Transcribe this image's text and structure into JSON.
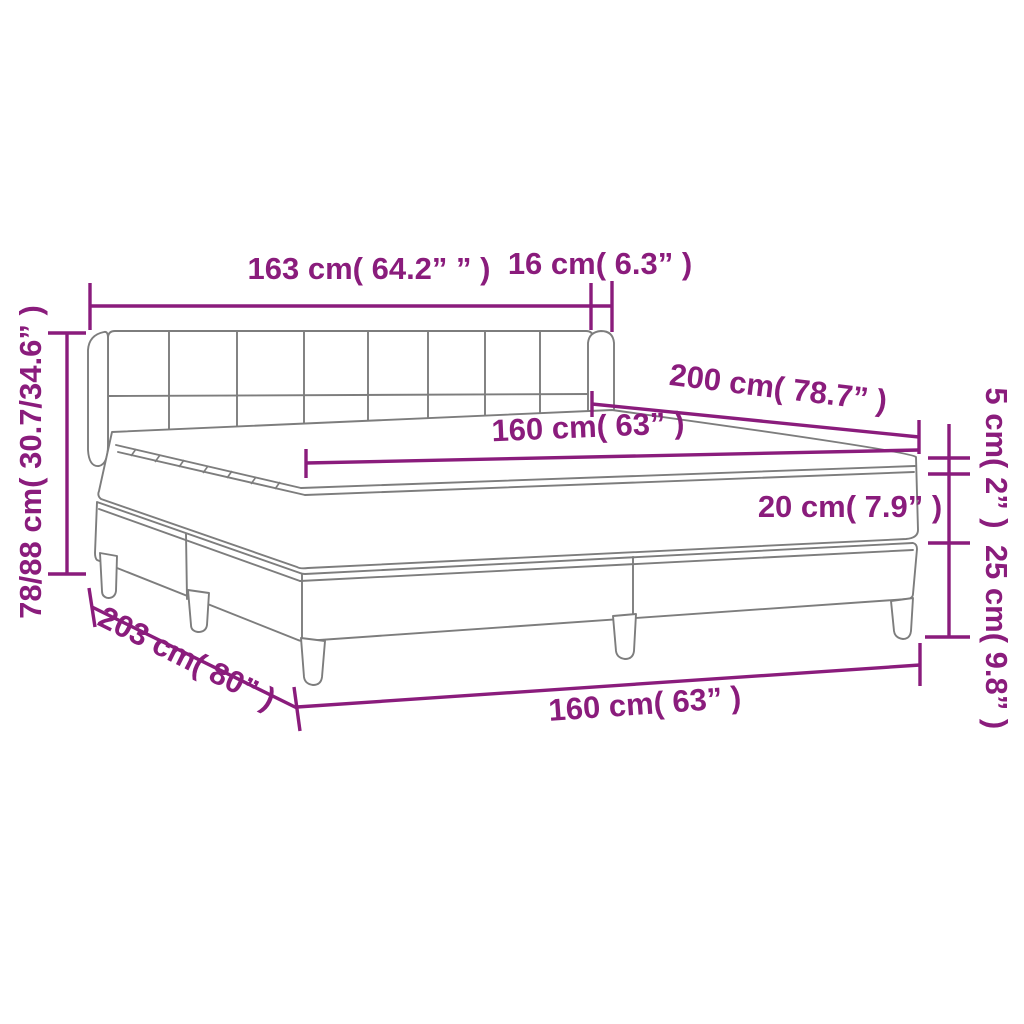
{
  "diagram": {
    "type": "product-dimension-diagram",
    "subject": "box spring bed with headboard, mattress and topper",
    "colors": {
      "dimension_accent": "#8a1c7c",
      "drawing_line": "#7d7d7d",
      "background": "#ffffff"
    },
    "labels": {
      "headboard_width": "163 cm( 64.2” ” )",
      "ear_depth": "16 cm( 6.3” )",
      "mattress_length": "200 cm( 78.7” )",
      "mattress_width_top": "160 cm( 63” )",
      "mattress_height": "20 cm( 7.9” )",
      "topper_height": "5 cm( 2” )",
      "base_height": "25 cm( 9.8” )",
      "total_height": "78/88 cm( 30.7/34.6” )",
      "frame_length": "203 cm( 80” )",
      "mattress_width_bottom": "160 cm( 63” )"
    },
    "measurements": [
      {
        "name": "headboard width",
        "cm": "163",
        "inches": "64.2"
      },
      {
        "name": "side ear depth",
        "cm": "16",
        "inches": "6.3"
      },
      {
        "name": "bed length",
        "cm": "200",
        "inches": "78.7"
      },
      {
        "name": "mattress width",
        "cm": "160",
        "inches": "63"
      },
      {
        "name": "mattress height",
        "cm": "20",
        "inches": "7.9"
      },
      {
        "name": "topper height",
        "cm": "5",
        "inches": "2"
      },
      {
        "name": "base height with legs",
        "cm": "25",
        "inches": "9.8"
      },
      {
        "name": "total height",
        "cm": "78/88",
        "inches": "30.7/34.6"
      },
      {
        "name": "frame length",
        "cm": "203",
        "inches": "80"
      },
      {
        "name": "frame width",
        "cm": "160",
        "inches": "63"
      }
    ]
  }
}
